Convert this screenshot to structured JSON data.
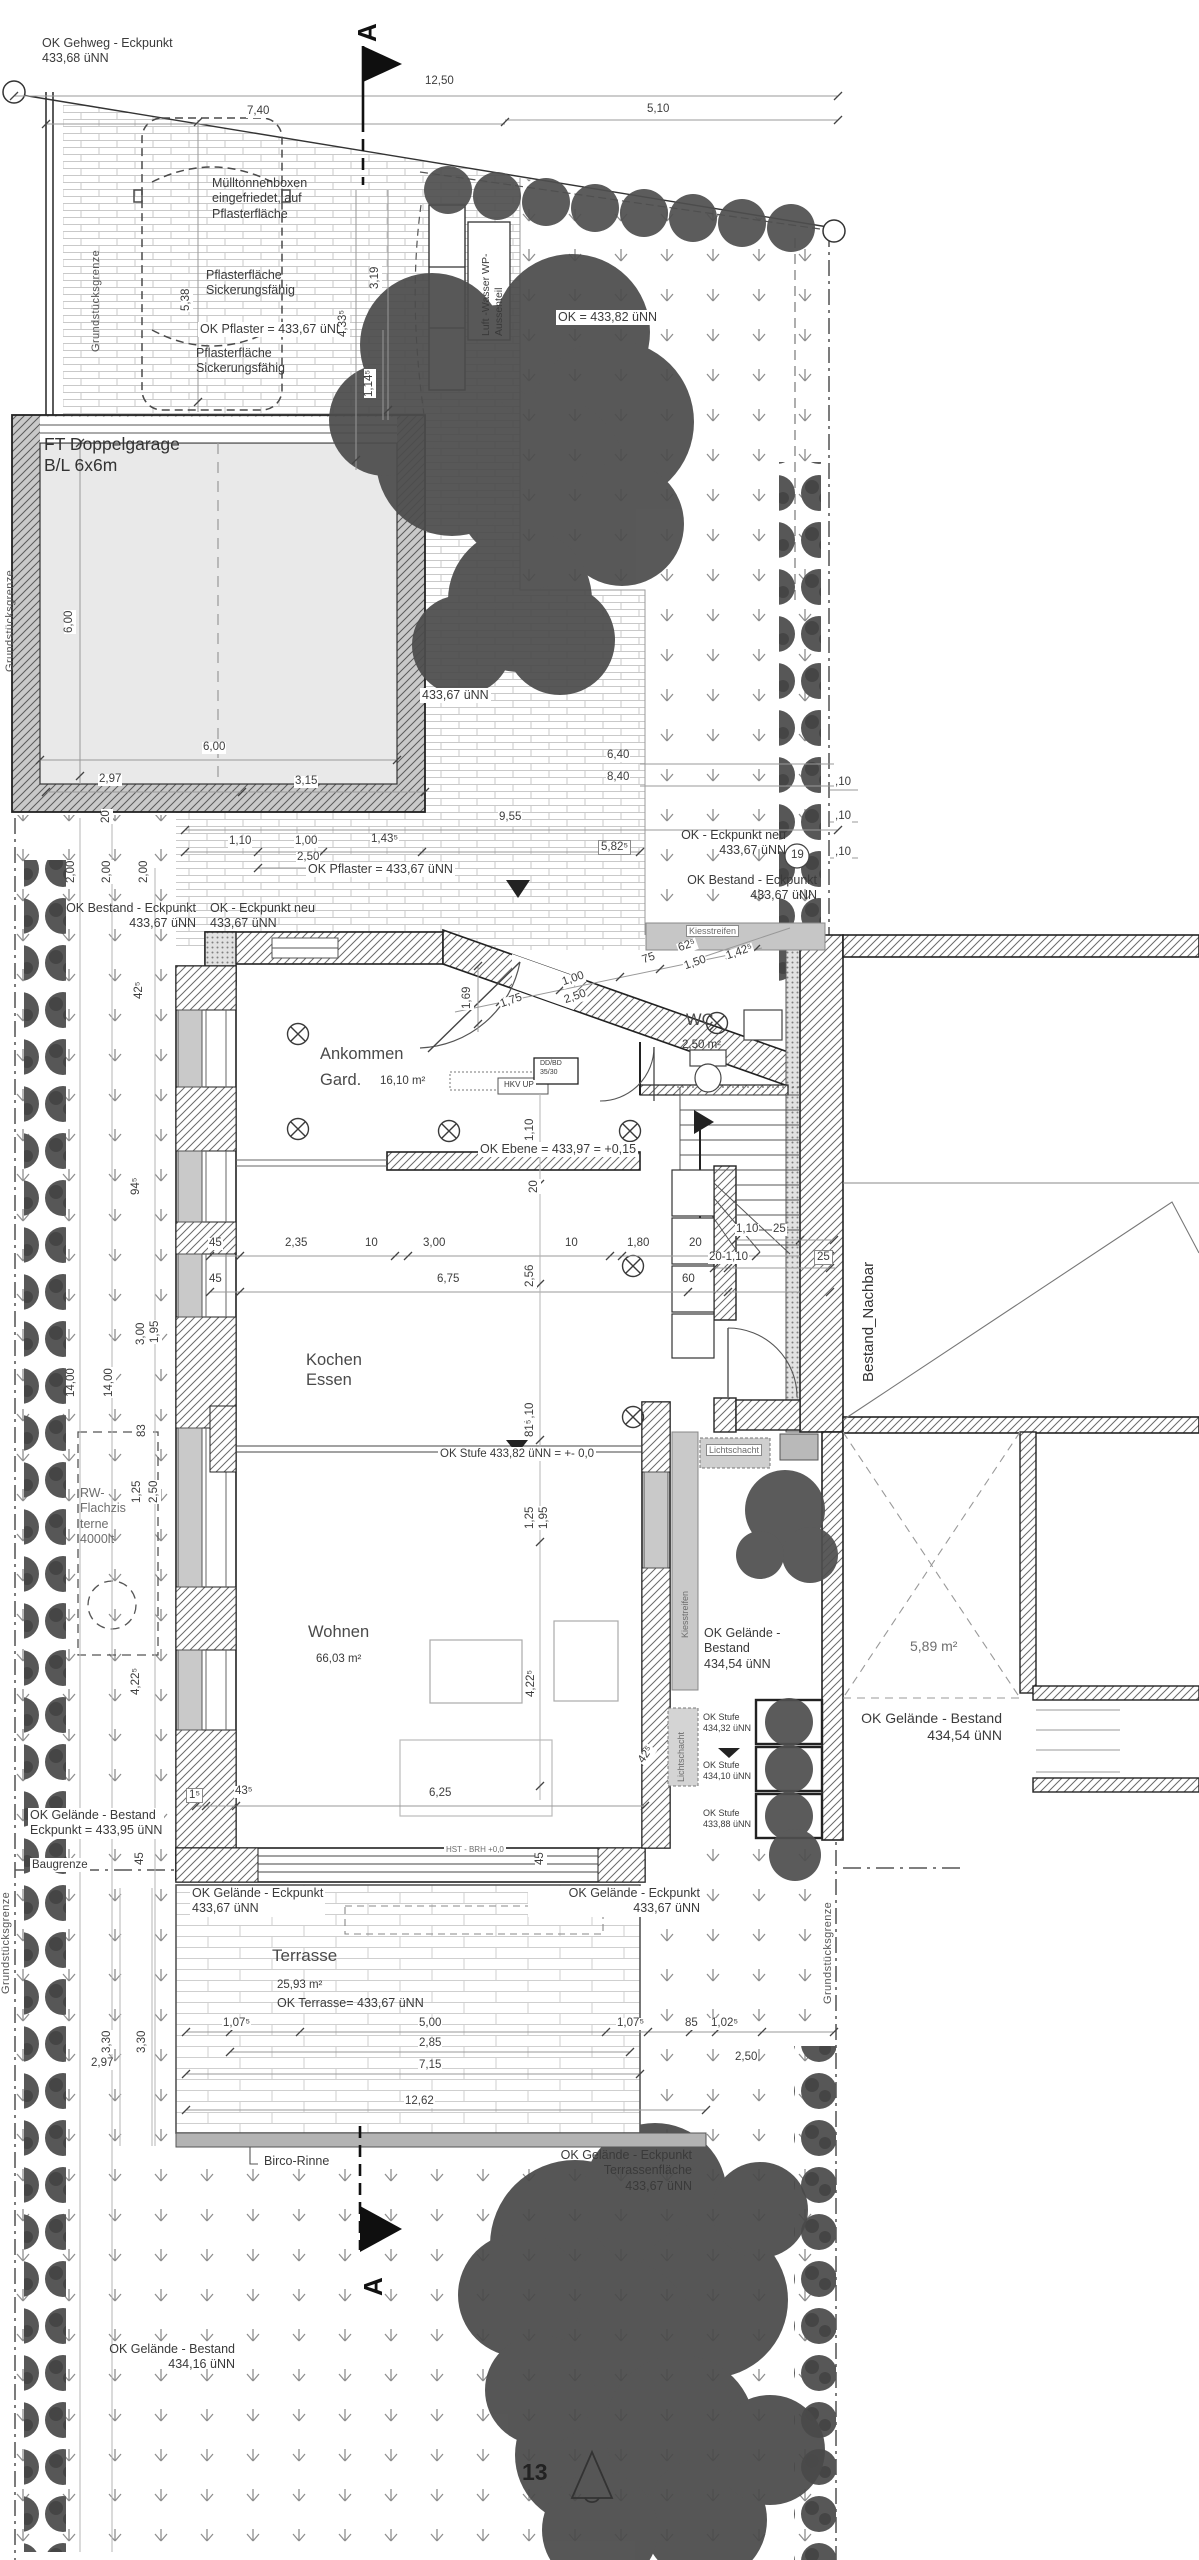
{
  "palette": {
    "paper": "#ffffff",
    "line": "#3b3b3b",
    "wall_fill": "#c9c9c9",
    "garage_fill": "#e9e9e9",
    "tree": "#4c4c4c",
    "gravel": "#c6c6c6"
  },
  "site": {
    "ok_gehweg": "OK Gehweg - Eckpunkt\n433,68 üNN",
    "section_a": "A",
    "muell": "Mülltonnenboxen\neingefriedet, auf\nPflasterfläche",
    "pflaster_sicker_1": "Pflasterfläche\nSickerungsfähig",
    "ok_pflaster_1": "OK Pflaster = 433,67 üNN",
    "pflaster_sicker_2": "Pflasterfläche\nSickerungsfähig",
    "wp": "Luft -Wasser WP-\nAussenteil",
    "ok_433_82": "OK = 433,82 üNN",
    "h_433_67": "433,67 üNN",
    "ok_pflaster_2": "OK Pflaster = 433,67 üNN",
    "ok_bestand_l": "OK Bestand - Eckpunkt\n433,67 üNN",
    "ok_neu_l": "OK - Eckpunkt neu\n433,67 üNN",
    "ok_neu_r": "OK - Eckpunkt neu\n433,67 üNN",
    "ok_bestand_r": "OK Bestand - Eckpunkt\n433,67 üNN",
    "marker19": "19",
    "kiesstreifen_top": "Kiesstreifen"
  },
  "garage": {
    "label": "FT Doppelgarage\nB/L 6x6m"
  },
  "house": {
    "ankommen": "Ankommen",
    "gard": "Gard.",
    "gard_area": "16,10 m²",
    "wc": "WC",
    "wc_area": "2,50 m²",
    "kochen": "Kochen\nEssen",
    "wohnen": "Wohnen",
    "wohnen_area": "66,03 m²",
    "ok_ebene": "OK Ebene = 433,97 = +0,15",
    "ok_stufe": "OK Stufe 433,82 üNN = +- 0,0",
    "hkv": "HKV UP",
    "ddbd": "DD/BD\n35/30",
    "hst": "HST - BRH +0,0"
  },
  "right": {
    "lichtschacht1": "Lichtschacht",
    "lichtschacht2": "Lichtschacht",
    "kiesstreifen_v": "Kiesstreifen",
    "ok_gel_1": "OK Gelände -\nBestand\n434,54 üNN",
    "stufe32": "OK Stufe\n434,32 üNN",
    "stufe10": "OK Stufe\n434,10 üNN",
    "stufe88": "OK Stufe\n433,88 üNN",
    "nachbar": "Bestand_Nachbar",
    "area589": "5,89 m²",
    "ok_gel_2": "OK Gelände - Bestand\n434,54 üNN",
    "grenze": "Grundstücksgrenze"
  },
  "left": {
    "grenze1": "Grundstücksgrenze",
    "grenze2": "Grundstücksgrenze",
    "grenze3": "Grundstücksgrenze",
    "baugrenze": "Baugrenze",
    "ok_gel_eck": "OK Gelände - Bestand\nEckpunkt = 433,95 üNN",
    "zisterne": "RW-\nFlachzis\nterne\n4000lt"
  },
  "terrace": {
    "name": "Terrasse",
    "area": "25,93 m²",
    "ok": "OK Terrasse= 433,67 üNN",
    "eck1": "OK Gelände - Eckpunkt\n433,67 üNN",
    "eck2": "OK Gelände - Eckpunkt\n433,67 üNN",
    "birco": "Birco-Rinne",
    "eck_terr": "OK Gelände - Eckpunkt\nTerrassenfläche\n433,67 üNN"
  },
  "bottom": {
    "section_a": "A",
    "ok_gel": "OK Gelände - Bestand\n434,16 üNN",
    "tag13": "13"
  },
  "dims": {
    "a1": "12,50",
    "a2": "7,40",
    "a3": "5,10",
    "a4": "5,38",
    "a5": "3,19",
    "a6": "4,33⁵",
    "a7": "1,14⁵",
    "g1": "6,00",
    "g2": "6,00",
    "g3": "2,97",
    "g4": "3,15",
    "g5": "20",
    "m1": "9,55",
    "m2": "1,10",
    "m3": "1,00",
    "m4": "1,43⁵",
    "m5": "2,50",
    "m6": "5,82⁵",
    "m7": "6,40",
    "m8": "8,40",
    "m9": ",10",
    "m10": ",10",
    "m11": ",10",
    "m12": "2,00",
    "m13": "2,00",
    "m14": "2,00",
    "m15": "1,42⁵",
    "m16": "42⁵",
    "e1": "1,69",
    "e2": "1,75",
    "e3": "1,00",
    "e4": "2,50",
    "e5": "75",
    "e6": "62⁵",
    "e7": "1,50",
    "e8": "1,10",
    "k1": "45",
    "k2": "2,35",
    "k3": "10",
    "k4": "3,00",
    "k5": "10",
    "k6": "1,80",
    "k7": "20",
    "k8": "1,10",
    "k9": "25",
    "k10": "45",
    "k11": "6,75",
    "k12": "60",
    "k13": "20-1,10",
    "k14": "25",
    "k15": "2,56",
    "k16": "1,10",
    "k17": "20",
    "w1": "81⁵",
    "w2": "1,25",
    "w3": "1,95",
    "w4": "4,22⁵",
    "w5": "4,22⁵",
    "w6": "1⁵",
    "w7": "43⁵",
    "w8": "6,25",
    "w9": "45",
    "w10": "45",
    "l1": "94⁵",
    "l2": "3,00",
    "l3": "1,95",
    "l4": "83",
    "l5": "1,25",
    "l6": "2,50",
    "l7": "14,00",
    "l8": "14,00",
    "r1": "42⁵",
    "t1": "1,07⁵",
    "t2": "5,00",
    "t3": "2,85",
    "t4": "7,15",
    "t5": "12,62",
    "t6": "1,07⁵",
    "t7": "85",
    "t8": "1,02⁵",
    "t9": "2,50",
    "t10": "3,30",
    "t11": "3,30",
    "t12": "2,97"
  }
}
